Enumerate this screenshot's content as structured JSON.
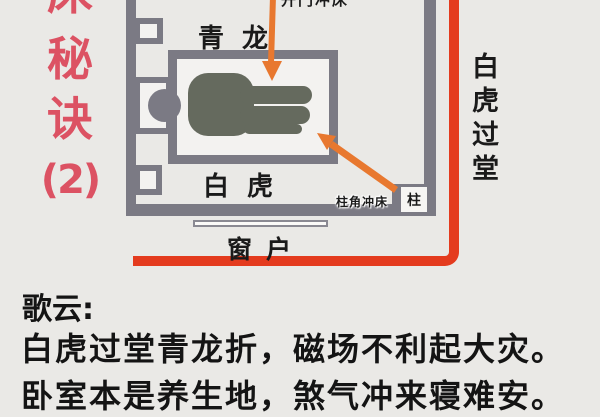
{
  "title": {
    "chars": [
      "床",
      "秘",
      "诀",
      "(2)"
    ],
    "color": "#dc5263"
  },
  "diagram": {
    "labels": {
      "azure_dragon": "青龙",
      "white_tiger": "白虎",
      "window": "窗户",
      "pillar_corner_hits_bed": "柱角冲床",
      "pillar": "柱",
      "white_tiger_passes_hall": "白虎过堂",
      "top_label_clipped": "开门冲床"
    },
    "colors": {
      "background": "#eae9e6",
      "wall": "#7b7a84",
      "person": "#656a5e",
      "arrow_orange": "#e8782f",
      "red_line": "#e43b1e",
      "title_red": "#dc5263",
      "text_black": "#141414"
    }
  },
  "verse": {
    "heading": "歌云:",
    "line1": "白虎过堂青龙折，磁场不利起大灾。",
    "line2": "卧室本是养生地，煞气冲来寝难安。"
  }
}
